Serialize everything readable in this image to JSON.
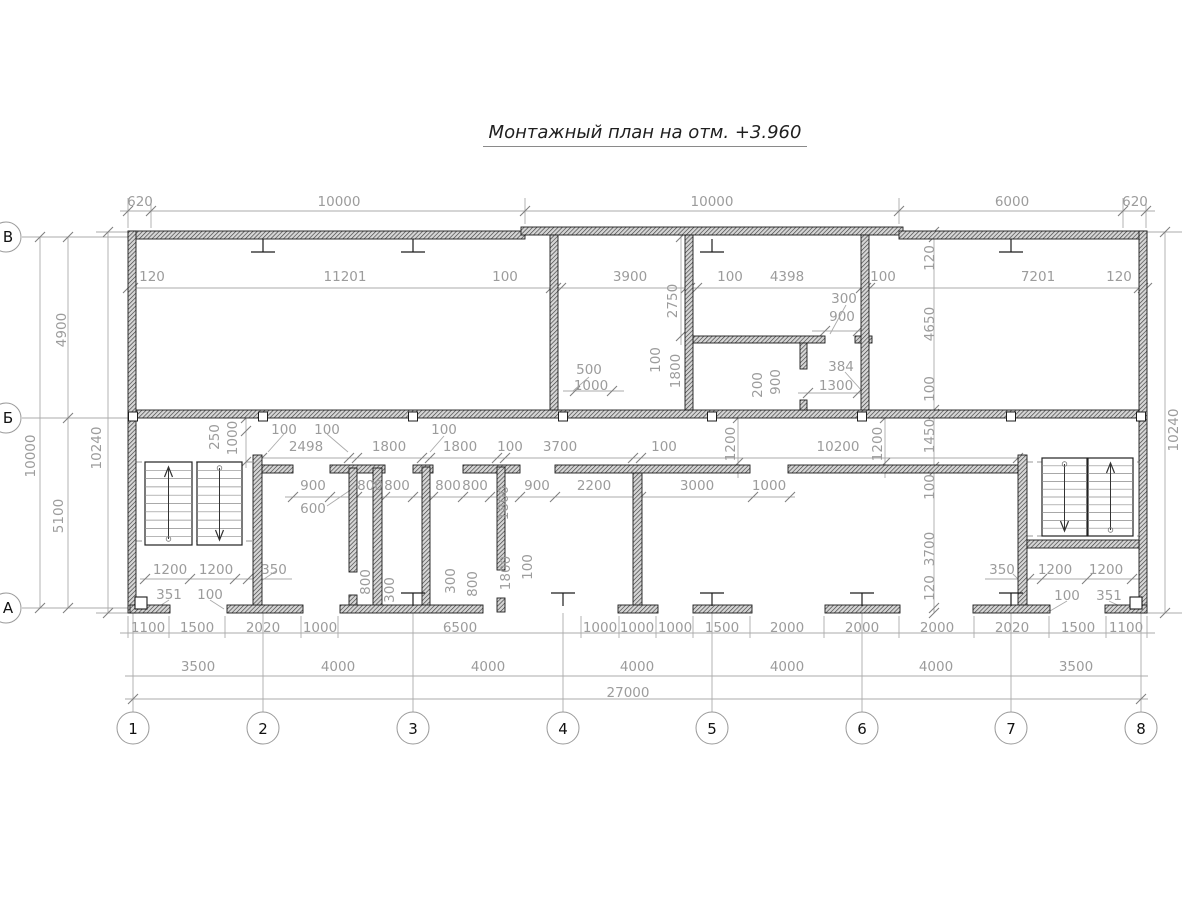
{
  "title": {
    "text": "Монтажный план на отм. +3.960"
  },
  "axes": {
    "row_labels": [
      {
        "label": "В",
        "y": 237
      },
      {
        "label": "Б",
        "y": 418
      },
      {
        "label": "А",
        "y": 608
      }
    ],
    "column_labels": [
      {
        "label": "1",
        "x": 133
      },
      {
        "label": "2",
        "x": 263
      },
      {
        "label": "3",
        "x": 413
      },
      {
        "label": "4",
        "x": 563
      },
      {
        "label": "5",
        "x": 712
      },
      {
        "label": "6",
        "x": 862
      },
      {
        "label": "7",
        "x": 1011
      },
      {
        "label": "8",
        "x": 1141
      }
    ]
  },
  "dimensions": {
    "top_chain": {
      "y": 202,
      "items": [
        {
          "t": "620",
          "x": 140
        },
        {
          "t": "10000",
          "x": 339
        },
        {
          "t": "10000",
          "x": 712
        },
        {
          "t": "6000",
          "x": 1012
        },
        {
          "t": "620",
          "x": 1135
        }
      ]
    },
    "wall_row_top": {
      "y": 277,
      "items": [
        {
          "t": "120",
          "x": 152
        },
        {
          "t": "11201",
          "x": 345
        },
        {
          "t": "100",
          "x": 505
        },
        {
          "t": "3900",
          "x": 630
        },
        {
          "t": "100",
          "x": 730
        },
        {
          "t": "4398",
          "x": 787
        },
        {
          "t": "100",
          "x": 883
        },
        {
          "t": "7201",
          "x": 1038
        },
        {
          "t": "120",
          "x": 1119
        }
      ]
    },
    "room_upper_mid": {
      "items": [
        {
          "t": "300",
          "x": 844,
          "y": 299
        },
        {
          "t": "900",
          "x": 842,
          "y": 317
        },
        {
          "t": "500",
          "x": 589,
          "y": 370
        },
        {
          "t": "1000",
          "x": 591,
          "y": 386
        },
        {
          "t": "384",
          "x": 841,
          "y": 367
        },
        {
          "t": "1300",
          "x": 836,
          "y": 386
        }
      ]
    },
    "upper_verticals": {
      "rot": true,
      "items": [
        {
          "t": "2750",
          "x": 673,
          "y": 301
        },
        {
          "t": "100",
          "x": 656,
          "y": 360
        },
        {
          "t": "1800",
          "x": 676,
          "y": 371
        },
        {
          "t": "200",
          "x": 758,
          "y": 385
        },
        {
          "t": "900",
          "x": 776,
          "y": 382
        }
      ]
    },
    "corridor_row": {
      "y": 447,
      "items": [
        {
          "t": "2498",
          "x": 306
        },
        {
          "t": "1800",
          "x": 389
        },
        {
          "t": "1800",
          "x": 460
        },
        {
          "t": "100",
          "x": 510
        },
        {
          "t": "3700",
          "x": 560
        },
        {
          "t": "100",
          "x": 664
        },
        {
          "t": "10200",
          "x": 838
        }
      ]
    },
    "corridor_small": {
      "y": 430,
      "items": [
        {
          "t": "100",
          "x": 284
        },
        {
          "t": "100",
          "x": 327
        },
        {
          "t": "100",
          "x": 444
        }
      ]
    },
    "corridor_verticals": {
      "rot": true,
      "items": [
        {
          "t": "250",
          "x": 215,
          "y": 437
        },
        {
          "t": "1000",
          "x": 233,
          "y": 438
        },
        {
          "t": "1200",
          "x": 731,
          "y": 444
        },
        {
          "t": "1200",
          "x": 878,
          "y": 444
        }
      ]
    },
    "stall_row": {
      "y": 486,
      "items": [
        {
          "t": "900",
          "x": 313
        },
        {
          "t": "800",
          "x": 370
        },
        {
          "t": "800",
          "x": 397
        },
        {
          "t": "800",
          "x": 448
        },
        {
          "t": "800",
          "x": 475
        },
        {
          "t": "900",
          "x": 537
        },
        {
          "t": "2200",
          "x": 594
        },
        {
          "t": "3000",
          "x": 697
        },
        {
          "t": "1000",
          "x": 769
        }
      ]
    },
    "stall_extra": {
      "items": [
        {
          "t": "600",
          "x": 313,
          "y": 509
        }
      ]
    },
    "lower_verticals": {
      "rot": true,
      "items": [
        {
          "t": "1800",
          "x": 504,
          "y": 503
        },
        {
          "t": "800",
          "x": 366,
          "y": 582
        },
        {
          "t": "300",
          "x": 390,
          "y": 590
        },
        {
          "t": "300",
          "x": 451,
          "y": 581
        },
        {
          "t": "800",
          "x": 473,
          "y": 584
        },
        {
          "t": "1800",
          "x": 506,
          "y": 573
        },
        {
          "t": "100",
          "x": 528,
          "y": 567
        }
      ]
    },
    "right_chain": {
      "rot": true,
      "items": [
        {
          "t": "120",
          "x": 930,
          "y": 258
        },
        {
          "t": "4650",
          "x": 930,
          "y": 324
        },
        {
          "t": "100",
          "x": 930,
          "y": 389
        },
        {
          "t": "1450",
          "x": 930,
          "y": 436
        },
        {
          "t": "100",
          "x": 930,
          "y": 487
        },
        {
          "t": "3700",
          "x": 930,
          "y": 549
        },
        {
          "t": "120",
          "x": 930,
          "y": 588
        }
      ]
    },
    "right_outer": {
      "rot": true,
      "items": [
        {
          "t": "10240",
          "x": 1174,
          "y": 430
        }
      ]
    },
    "left_chain": {
      "rot": true,
      "items": [
        {
          "t": "4900",
          "x": 62,
          "y": 330
        },
        {
          "t": "10000",
          "x": 31,
          "y": 456
        },
        {
          "t": "5100",
          "x": 59,
          "y": 516
        },
        {
          "t": "10240",
          "x": 97,
          "y": 448
        }
      ]
    },
    "room_bottom_left": {
      "items": [
        {
          "t": "1200",
          "x": 170,
          "y": 570
        },
        {
          "t": "1200",
          "x": 216,
          "y": 570
        },
        {
          "t": "350",
          "x": 274,
          "y": 570
        },
        {
          "t": "351",
          "x": 169,
          "y": 595
        },
        {
          "t": "100",
          "x": 210,
          "y": 595
        }
      ]
    },
    "room_bottom_right": {
      "items": [
        {
          "t": "350",
          "x": 1002,
          "y": 570
        },
        {
          "t": "1200",
          "x": 1055,
          "y": 570
        },
        {
          "t": "1200",
          "x": 1106,
          "y": 570
        },
        {
          "t": "100",
          "x": 1067,
          "y": 596
        },
        {
          "t": "351",
          "x": 1109,
          "y": 596
        }
      ]
    },
    "bottom_row1": {
      "y": 628,
      "items": [
        {
          "t": "1100",
          "x": 148
        },
        {
          "t": "1500",
          "x": 197
        },
        {
          "t": "2020",
          "x": 263
        },
        {
          "t": "1000",
          "x": 320
        },
        {
          "t": "6500",
          "x": 460
        },
        {
          "t": "1000",
          "x": 600
        },
        {
          "t": "1000",
          "x": 637
        },
        {
          "t": "1000",
          "x": 675
        },
        {
          "t": "1500",
          "x": 722
        },
        {
          "t": "2000",
          "x": 787
        },
        {
          "t": "2000",
          "x": 862
        },
        {
          "t": "2000",
          "x": 937
        },
        {
          "t": "2020",
          "x": 1012
        },
        {
          "t": "1500",
          "x": 1078
        },
        {
          "t": "1100",
          "x": 1126
        }
      ]
    },
    "bottom_row2": {
      "y": 667,
      "items": [
        {
          "t": "3500",
          "x": 198
        },
        {
          "t": "4000",
          "x": 338
        },
        {
          "t": "4000",
          "x": 488
        },
        {
          "t": "4000",
          "x": 637
        },
        {
          "t": "4000",
          "x": 787
        },
        {
          "t": "4000",
          "x": 936
        },
        {
          "t": "3500",
          "x": 1076
        }
      ]
    },
    "bottom_total": {
      "y": 693,
      "items": [
        {
          "t": "27000",
          "x": 628
        }
      ]
    }
  },
  "colors": {
    "dim_text": "#9c9c9c",
    "thin_line": "#ababab",
    "tick": "#7f7f7f",
    "wall_stroke": "#1c1c1c",
    "axis_text": "#111111"
  }
}
